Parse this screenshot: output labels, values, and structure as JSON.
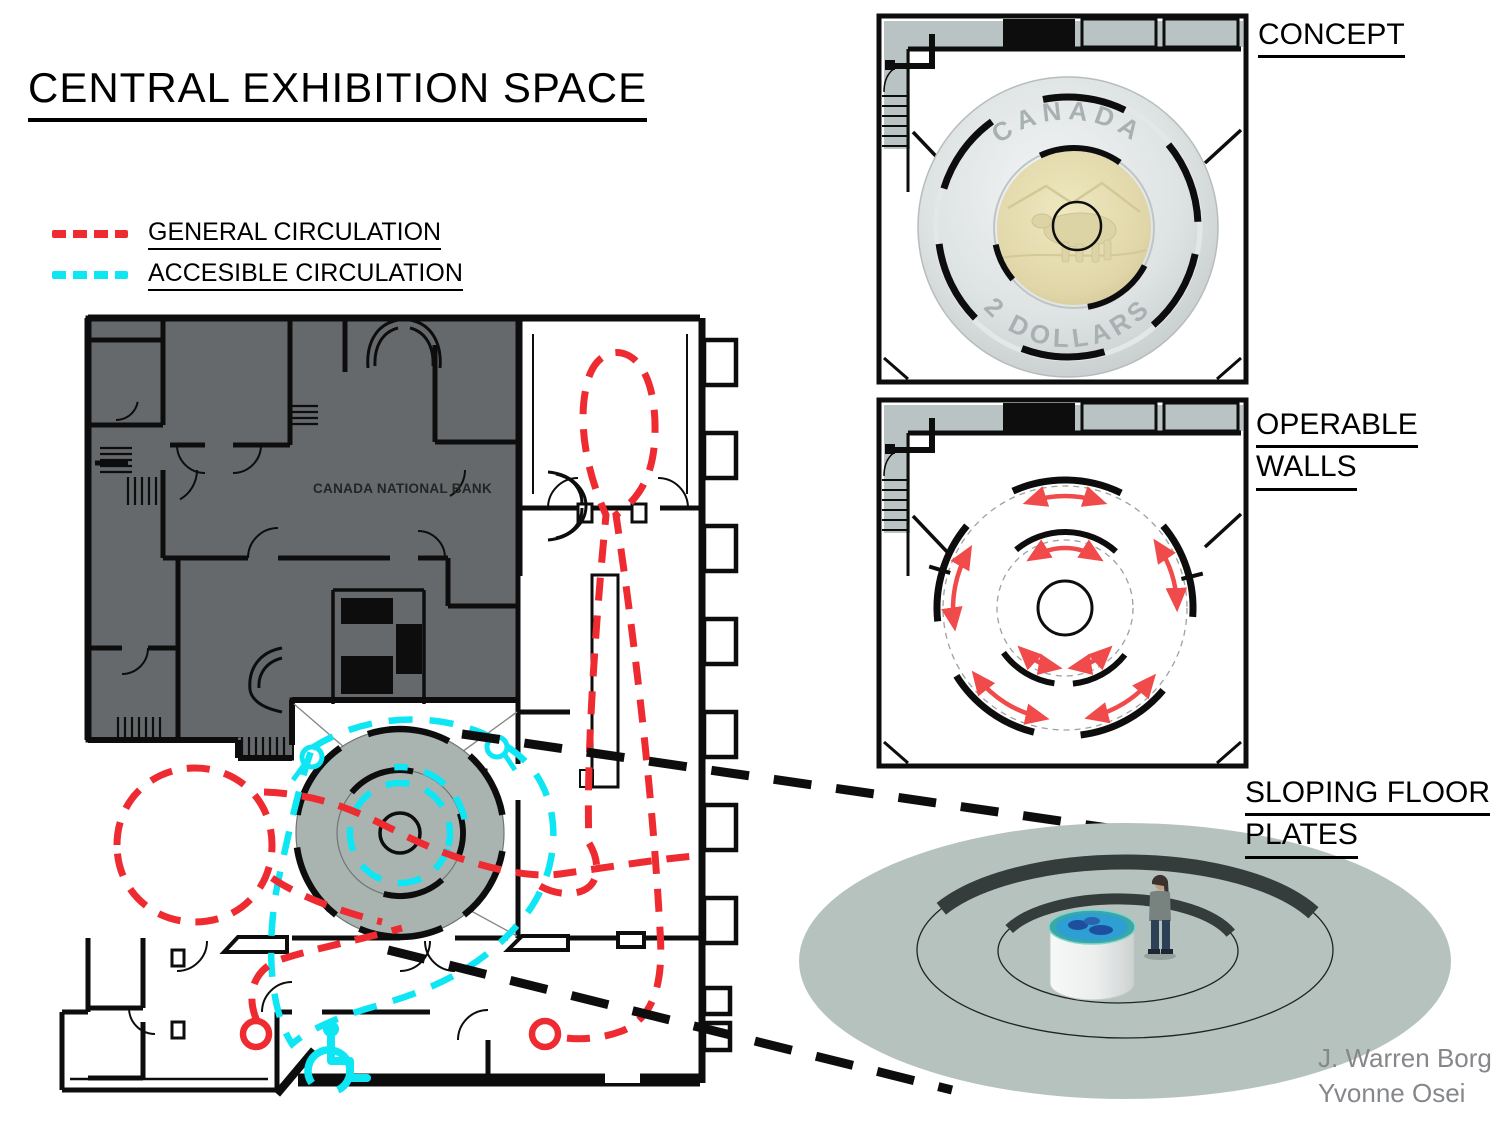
{
  "title": "CENTRAL EXHIBITION SPACE",
  "legend": {
    "items": [
      {
        "label": "GENERAL CIRCULATION",
        "color": "#ee2b31",
        "style": "dashed"
      },
      {
        "label": "ACCESIBLE CIRCULATION",
        "color": "#0ee6f3",
        "style": "dashed"
      }
    ]
  },
  "plan": {
    "building_label": "CANADA NATIONAL BANK",
    "accessibility_icon": "wheelchair",
    "central_space": "circular exhibition space with operable wall segments"
  },
  "panels": {
    "concept": {
      "label": "CONCEPT"
    },
    "operable_walls": {
      "label_line1": "OPERABLE",
      "label_line2": "WALLS"
    },
    "sloping_floor": {
      "label_line1": "SLOPING FLOOR",
      "label_line2": "PLATES"
    }
  },
  "coin": {
    "top_text": "CANADA",
    "bottom_text": "2 DOLLARS"
  },
  "credits": [
    "J. Warren Borg",
    "Yvonne Osei"
  ],
  "colors": {
    "general_circulation": "#ee2b31",
    "accessible_circulation": "#0ee6f3",
    "bank_fill": "#66696b",
    "panel_wall_fill": "#b9c3c3",
    "circle_space_fill": "#a9b4b1",
    "floor_plate_fill": "#b6c2be",
    "ring_shadow": "#343d3b",
    "coin_silver": "#ced3d4",
    "coin_gold": "#ddd2a2",
    "rotation_arrow": "#f04a4a",
    "credits_text": "#85878a",
    "section_line": "#0d0d0d"
  }
}
